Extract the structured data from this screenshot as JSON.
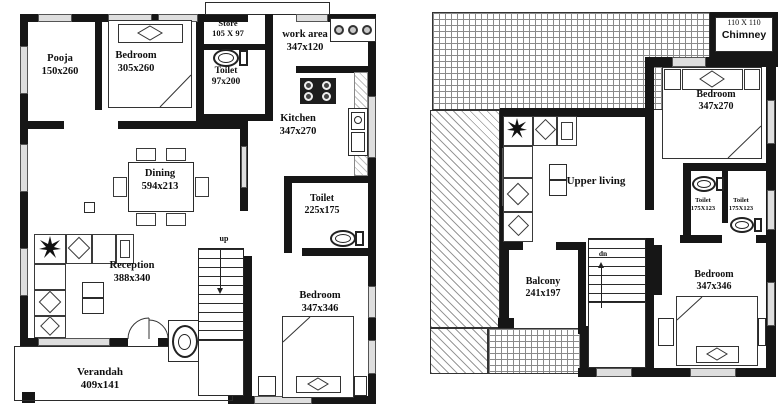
{
  "ground": {
    "pooja": {
      "label": "Pooja",
      "size": "150x260"
    },
    "bedroom_top": {
      "label": "Bedroom",
      "size": "305x260"
    },
    "store": {
      "label": "Store",
      "size": "105 X 97"
    },
    "toilet_top": {
      "label": "Toilet",
      "size": "97x200"
    },
    "work_area": {
      "label": "work area",
      "size": "347x120"
    },
    "kitchen": {
      "label": "Kitchen",
      "size": "347x270"
    },
    "dining": {
      "label": "Dining",
      "size": "594x213"
    },
    "toilet_mid": {
      "label": "Toilet",
      "size": "225x175"
    },
    "reception": {
      "label": "Reception",
      "size": "388x340"
    },
    "bedroom_bottom": {
      "label": "Bedroom",
      "size": "347x346"
    },
    "verandah": {
      "label": "Verandah",
      "size": "409x141"
    },
    "stair": {
      "label": "up"
    }
  },
  "upper": {
    "chimney": {
      "size_label": "110 X 110",
      "label": "Chimney"
    },
    "bedroom_top": {
      "label": "Bedroom",
      "size": "347x270"
    },
    "living": {
      "label": "Upper living"
    },
    "toilet_left": {
      "label": "Toilet",
      "size": "175X123"
    },
    "toilet_right": {
      "label": "Toilet",
      "size": "175X123"
    },
    "bedroom_bottom": {
      "label": "Bedroom",
      "size": "347x346"
    },
    "balcony": {
      "label": "Balcony",
      "size": "241x197"
    },
    "stair": {
      "label": "dn"
    }
  },
  "colors": {
    "wall": "#161616",
    "paper": "#ffffff",
    "hatch_line": "#8a8a8a"
  }
}
